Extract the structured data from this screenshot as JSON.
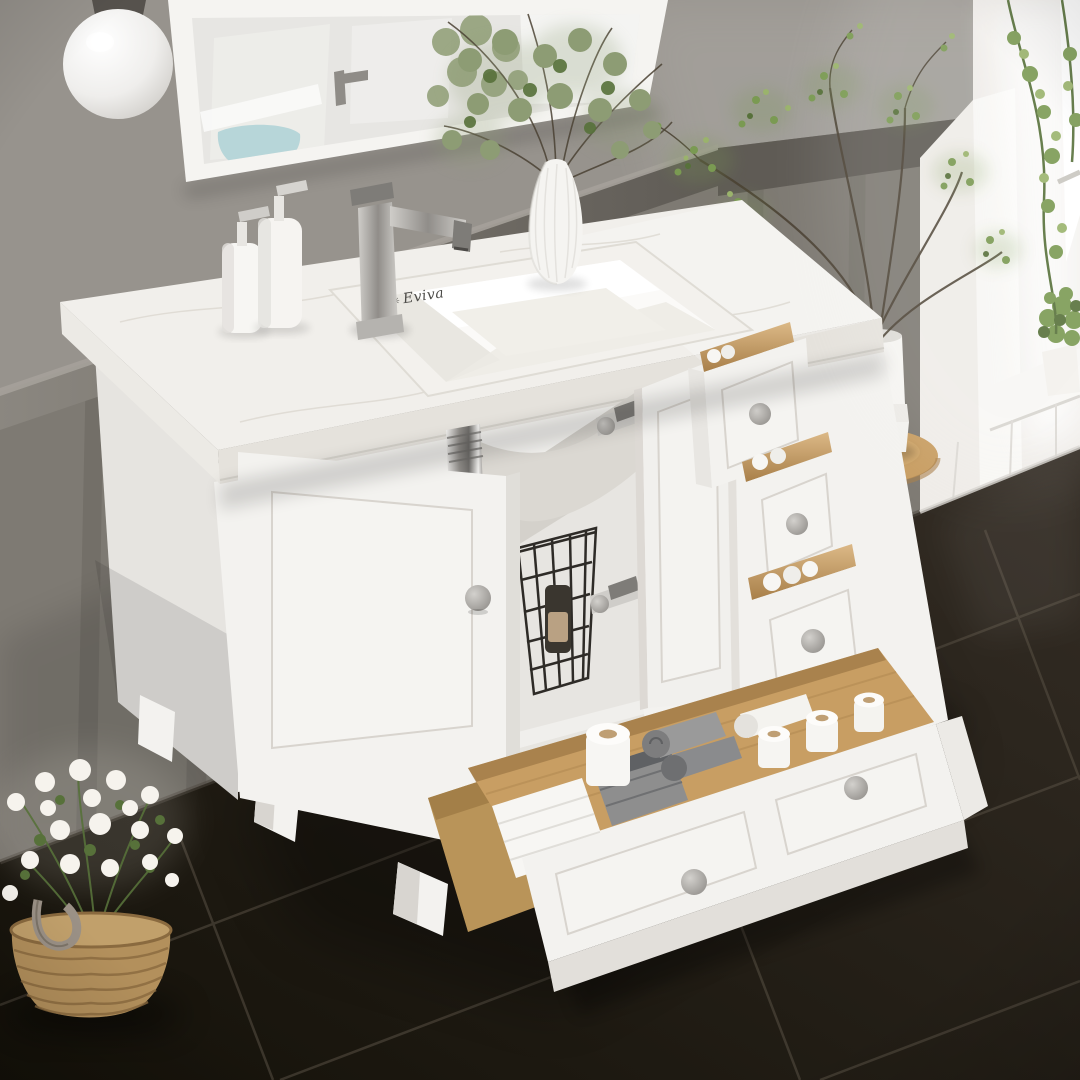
{
  "brand": {
    "mark": "✳",
    "name": "Eviva"
  },
  "colors": {
    "wall_upper": "#97938d",
    "wall_lower": "#7e7a73",
    "wall_rail": "#8b8780",
    "wall_rail_dark": "#5f5b55",
    "wall_batten": "#736f68",
    "white_wall": "#efece8",
    "white_trim": "#f8f7f4",
    "window_glow": "#ffffff",
    "mirror_frame": "#f5f4f1",
    "mirror_glass": "#e7e6e3",
    "reflection_teal": "#b7d6d9",
    "lamp_cap": "#56524d",
    "floor_light": "#342d25",
    "floor_dark": "#141109",
    "grout": "#585044",
    "cabinet_white": "#f3f2ef",
    "cabinet_side": "#e6e4e0",
    "cabinet_interior": "#e7e5e1",
    "counter_surface": "#f1efeb",
    "counter_edge": "#e5e2dc",
    "sink_white": "#fbfaf8",
    "metal_light": "#cfcdc9",
    "metal_mid": "#908d89",
    "metal_dark": "#7e7c78",
    "chrome_light": "#f0efed",
    "chrome_dark": "#6f6d6a",
    "knob_light": "#d3d1cd",
    "knob_dark": "#8b8884",
    "wood_light": "#dcb987",
    "wood_mid": "#c89e63",
    "wood_dark": "#a87f49",
    "wire_black": "#2e2b27",
    "towel_white": "#f7f6f3",
    "towel_gray": "#8e8e8e",
    "towel_charcoal": "#5f6164",
    "tp_core": "#bf9f74",
    "green_light": "#9ab36c",
    "green_mid": "#7a9a52",
    "green_dark": "#57713a",
    "sage": "#8d9c74",
    "branch": "#4a4133",
    "wicker": "#b3905c",
    "wicker_dark": "#8a6a3f",
    "flower_white": "#f6f3ed",
    "logo_ink": "#4b4a47"
  }
}
